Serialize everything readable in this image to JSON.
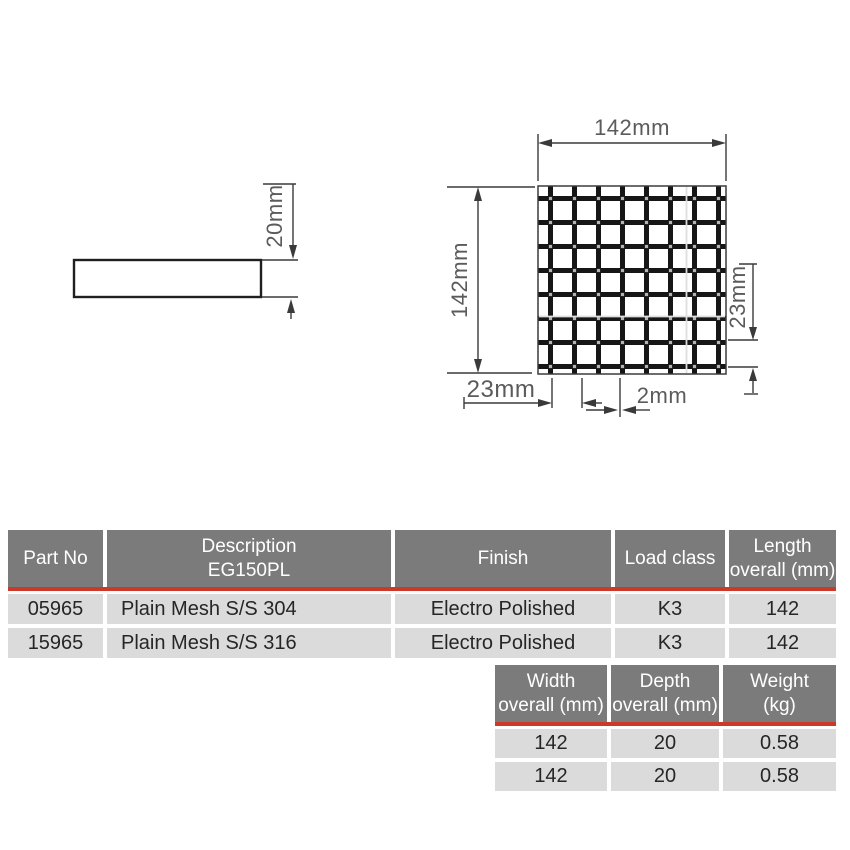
{
  "diagram": {
    "labels": {
      "side_height": "20mm",
      "grid_width": "142mm",
      "grid_height": "142mm",
      "pitch_right": "23mm",
      "pitch_bottom": "23mm",
      "bar_width": "2mm"
    },
    "colors": {
      "line": "#3a3a3a",
      "mesh_bar": "#161616",
      "label_text": "#5b5b5b"
    }
  },
  "table1": {
    "headers": {
      "part_no": "Part No",
      "description_line1": "Description",
      "description_line2": "EG150PL",
      "finish": "Finish",
      "load_class": "Load class",
      "length_line1": "Length",
      "length_line2": "overall (mm)"
    },
    "rows": [
      {
        "part_no": "05965",
        "description": "Plain Mesh S/S 304",
        "finish": "Electro Polished",
        "load_class": "K3",
        "length": "142"
      },
      {
        "part_no": "15965",
        "description": "Plain Mesh S/S 316",
        "finish": "Electro Polished",
        "load_class": "K3",
        "length": "142"
      }
    ]
  },
  "table2": {
    "headers": {
      "width_line1": "Width",
      "width_line2": "overall (mm)",
      "depth_line1": "Depth",
      "depth_line2": "overall (mm)",
      "weight_line1": "Weight",
      "weight_line2": "(kg)"
    },
    "rows": [
      {
        "width": "142",
        "depth": "20",
        "weight": "0.58"
      },
      {
        "width": "142",
        "depth": "20",
        "weight": "0.58"
      }
    ]
  },
  "colors": {
    "header_bg": "#7b7b7b",
    "row_bg": "#dbdbdb",
    "accent_red": "#cb3a28",
    "header_text": "#ffffff",
    "cell_text": "#262626"
  }
}
